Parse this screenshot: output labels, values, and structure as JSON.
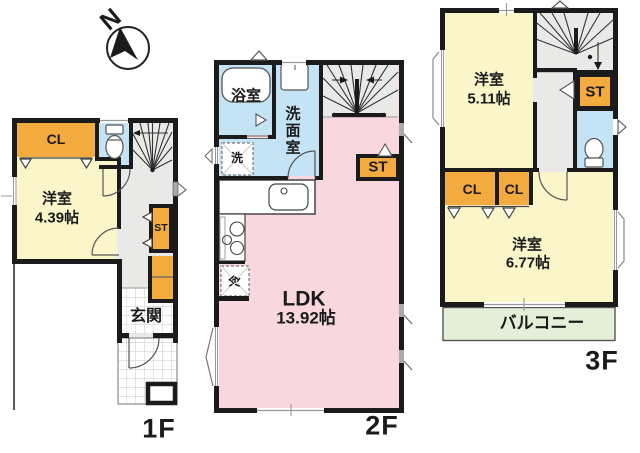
{
  "compass": {
    "north": "N"
  },
  "colors": {
    "wall": "#1b1b1b",
    "room-yellow": "#FAF6C9",
    "closet-orange": "#F3AA3F",
    "ldk-pink": "#F8D8DE",
    "wet-blue": "#C4E3F4",
    "hall-gray": "#E9E9E7",
    "balcony-green": "#E4EFD9"
  },
  "floor1": {
    "label": "1F",
    "closet": "CL",
    "room": {
      "name": "洋室",
      "size": "4.39帖"
    },
    "storage": "ST",
    "entrance": "玄関"
  },
  "floor2": {
    "label": "2F",
    "bath": "浴室",
    "washroom": "洗面室",
    "washer": "洗",
    "fridge": "冷",
    "storage": "ST",
    "ldk": {
      "name": "LDK",
      "size": "13.92帖"
    }
  },
  "floor3": {
    "label": "3F",
    "room_a": {
      "name": "洋室",
      "size": "5.11帖"
    },
    "storage": "ST",
    "closet_a": "CL",
    "closet_b": "CL",
    "room_b": {
      "name": "洋室",
      "size": "6.77帖"
    },
    "balcony": "バルコニー"
  }
}
